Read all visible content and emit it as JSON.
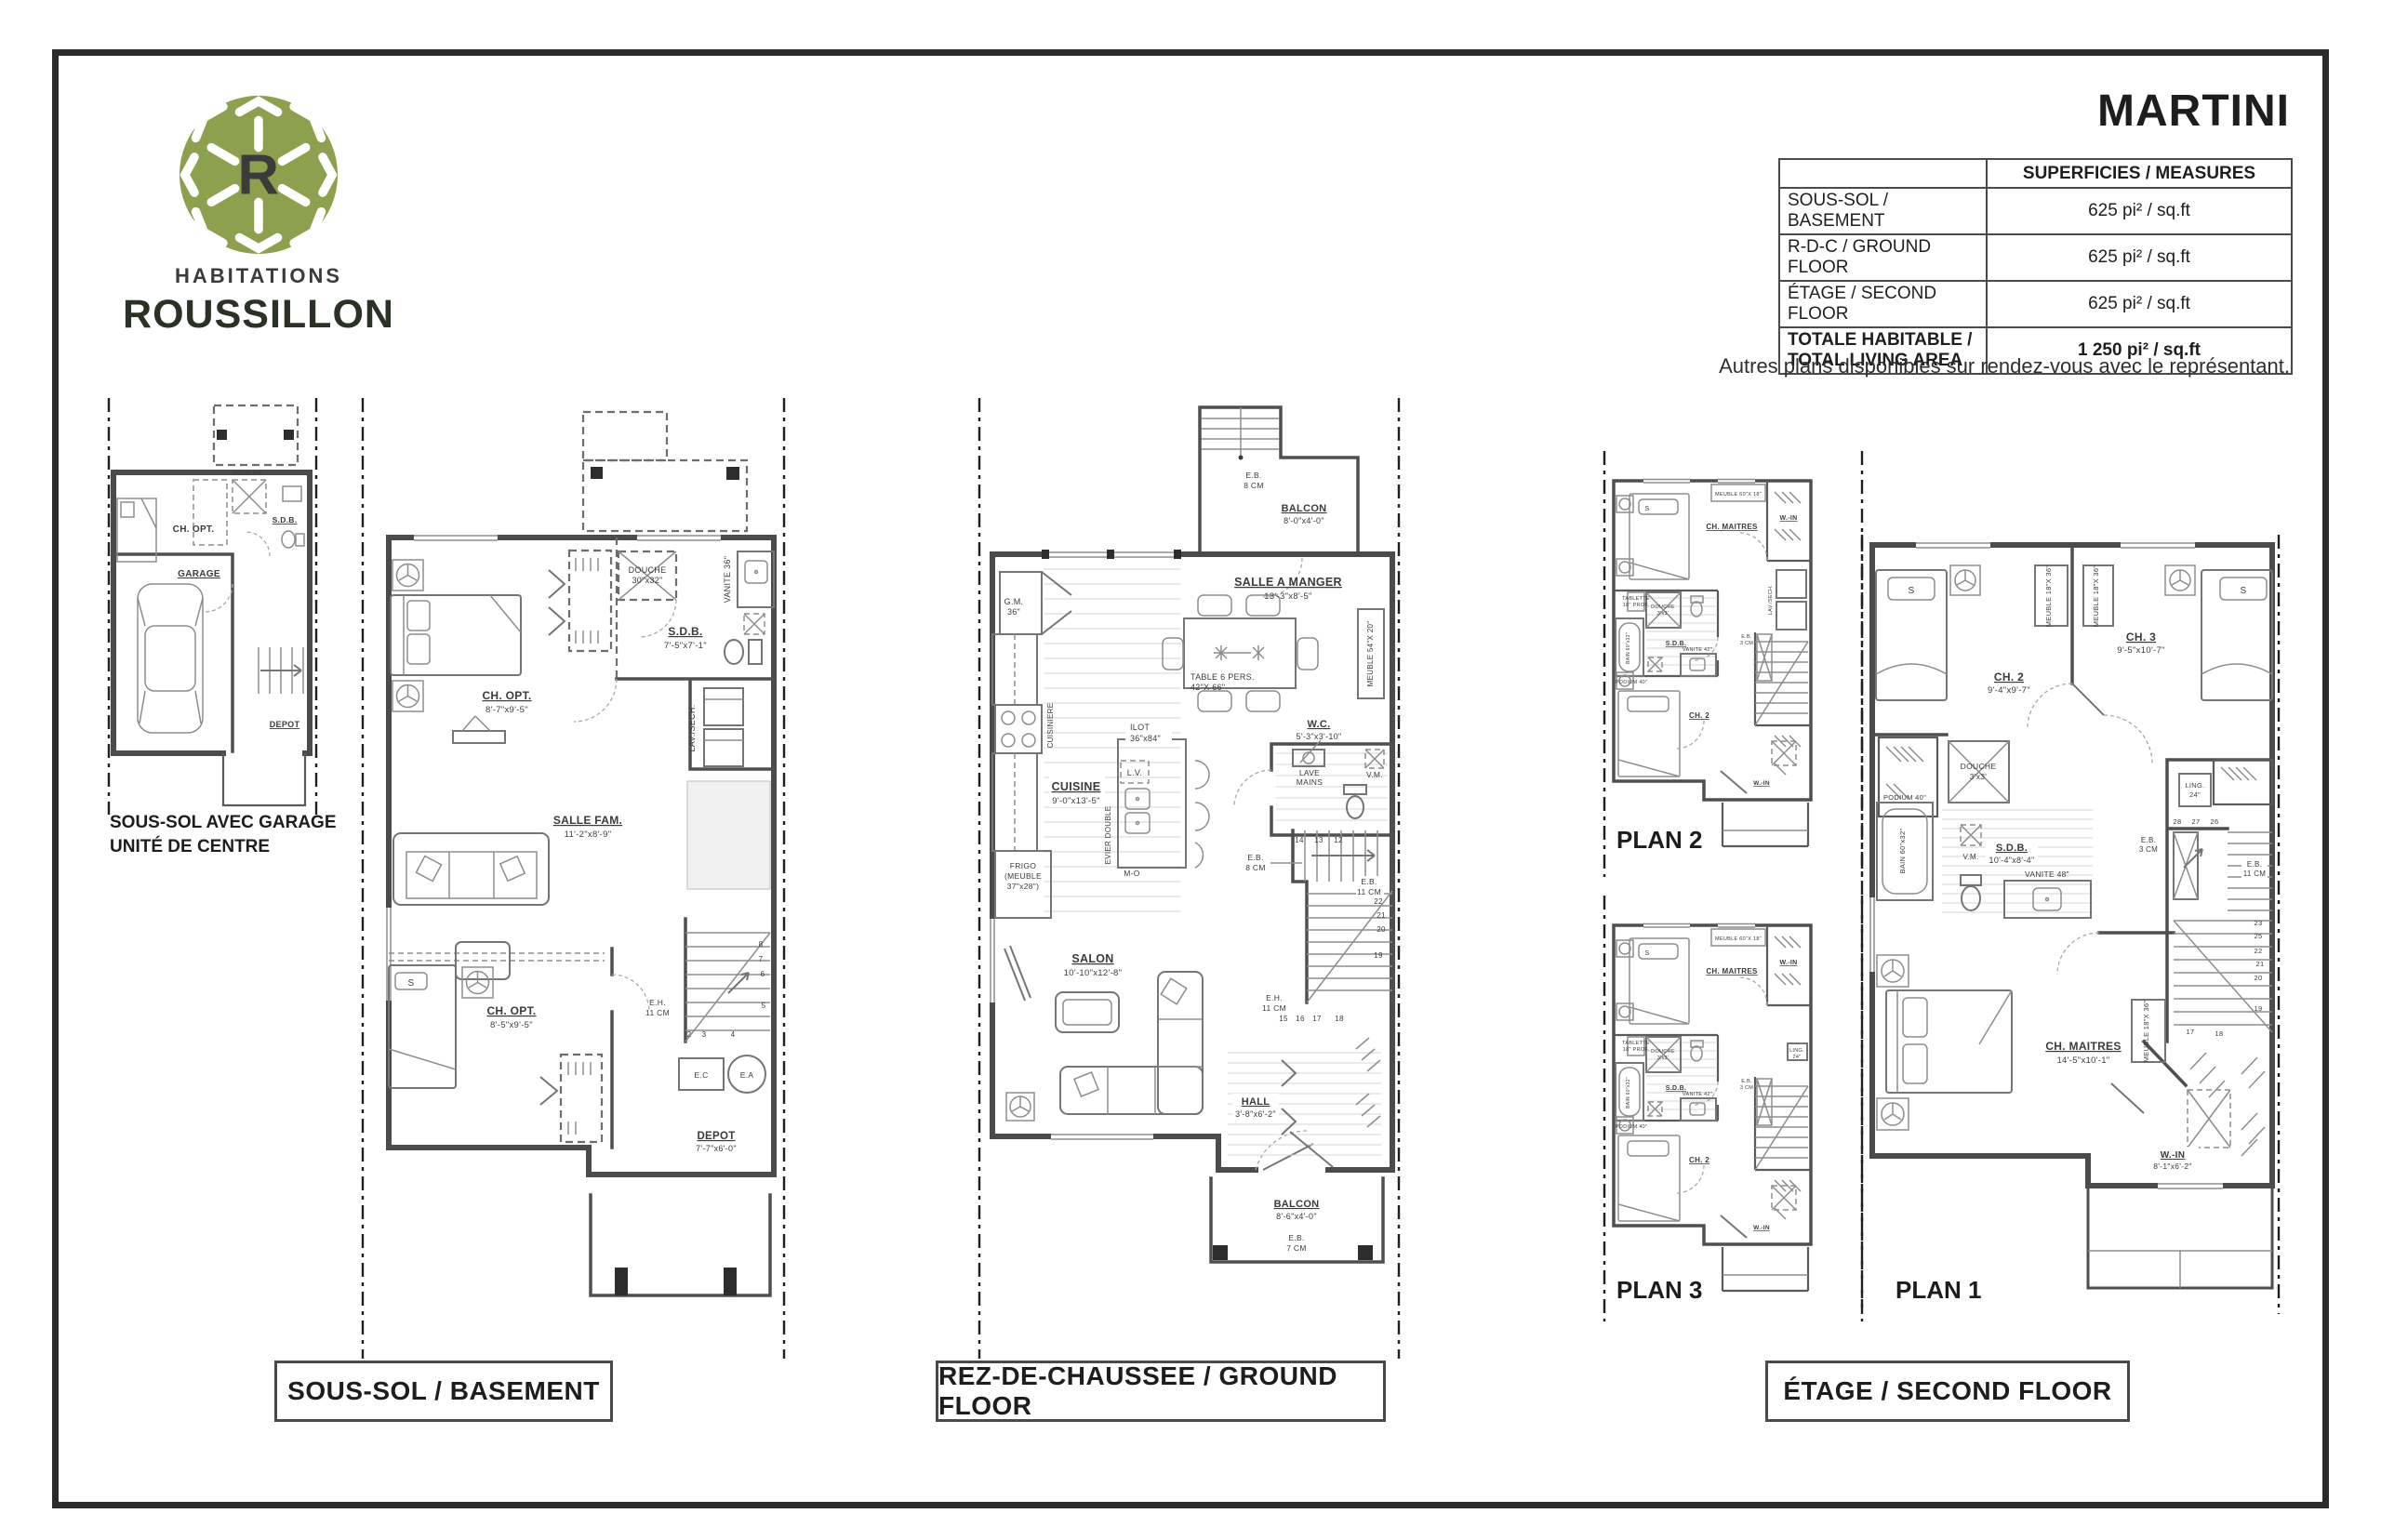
{
  "theme": {
    "ink": "#2b2b2b",
    "brand-green": "#8ca04e",
    "brand-dark": "#2a3226",
    "line-gray": "#4b4b4b"
  },
  "brand": {
    "monogram": "R",
    "line1": "HABITATIONS",
    "line2": "ROUSSILLON"
  },
  "header": {
    "title": "MARTINI",
    "note": "Autres plans disponibles sur rendez-vous avec le représentant."
  },
  "table": {
    "header": "SUPERFICIES / MEASURES",
    "rows": [
      {
        "label": "SOUS-SOL / BASEMENT",
        "value": "625 pi² / sq.ft"
      },
      {
        "label": "R-D-C / GROUND FLOOR",
        "value": "625 pi² / sq.ft"
      },
      {
        "label": "ÉTAGE / SECOND FLOOR",
        "value": "625 pi² / sq.ft"
      }
    ],
    "total": {
      "label1": "TOTALE HABITABLE /",
      "label2": "TOTAL LIVING AREA",
      "value": "1 250 pi² / sq.ft"
    }
  },
  "captions": {
    "basement": "SOUS-SOL / BASEMENT",
    "ground": "REZ-DE-CHAUSSEE / GROUND FLOOR",
    "etage": "ÉTAGE / SECOND FLOOR"
  },
  "plan_tags": {
    "plan1": "PLAN 1",
    "plan2": "PLAN 2",
    "plan3": "PLAN 3"
  },
  "garage_plan": {
    "caption1": "SOUS-SOL AVEC GARAGE",
    "caption2": "UNITÉ DE CENTRE",
    "ch_opt": "CH. OPT.",
    "garage": "GARAGE",
    "sdb": "S.D.B.",
    "douche": "DOUCHE",
    "depot": "DEPOT"
  },
  "basement": {
    "ch_opt_top": "CH. OPT.",
    "ch_opt_top_dim": "8'-7\"x9'-5\"",
    "douche": "DOUCHE",
    "douche_dim": "30\"x32\"",
    "vanite": "VANITE 36\"",
    "sdb": "S.D.B.",
    "sdb_dim": "7'-5\"x7'-1\"",
    "lav": "LAV./SECH.",
    "salle_fam": "SALLE FAM.",
    "salle_fam_dim": "11'-2\"x8'-9\"",
    "ch_opt_bot": "CH. OPT.",
    "ch_opt_bot_dim": "8'-5\"x9'-5\"",
    "eh1": "E.H.",
    "eh2": "11 CM",
    "ec": "E.C",
    "ea": "E.A",
    "depot": "DEPOT",
    "depot_dim": "7'-7\"x6'-0\"",
    "s": "S",
    "n2": "2",
    "n3": "3",
    "n4": "4",
    "n5": "5",
    "n6": "6",
    "n7": "7",
    "n8": "8"
  },
  "ground": {
    "eb_top1": "E.B.",
    "eb_top2": "8 CM",
    "balcon_top": "BALCON",
    "balcon_top_dim": "8'-0\"x4'-0\"",
    "salle": "SALLE A MANGER",
    "salle_dim": "13'-3\"x8'-5\"",
    "table1": "TABLE 6 PERS.",
    "table2": "42\"X 66\"",
    "meuble": "MEUBLE 54\"X 20\"",
    "gm1": "G.M.",
    "gm2": "36\"",
    "cuisiniere": "CUISINIERE",
    "cuisine": "CUISINE",
    "cuisine_dim": "9'-0\"x13'-5\"",
    "ilot1": "ILOT",
    "ilot2": "36\"x84\"",
    "lv": "L.V.",
    "evier": "EVIER DOUBLE",
    "frigo1": "FRIGO",
    "frigo2": "(MEUBLE",
    "frigo3": "37\"x28\")",
    "mo": "M-O",
    "wc": "W.C.",
    "wc_dim": "5'-3\"x3'-10\"",
    "lave1": "LAVE",
    "lave2": "MAINS",
    "vm": "V.M.",
    "ebA1": "E.B.",
    "ebA2": "8 CM",
    "ebB1": "E.B.",
    "ebB2": "11 CM",
    "eh1": "E.H.",
    "eh2": "11 CM",
    "salon": "SALON",
    "salon_dim": "10'-10\"x12'-8\"",
    "hall": "HALL",
    "hall_dim": "3'-8\"x6'-2\"",
    "balcon_bot": "BALCON",
    "balcon_bot_dim": "8'-6\"x4'-0\"",
    "eb_bot1": "E.B.",
    "eb_bot2": "7 CM",
    "n12": "12",
    "n13": "13",
    "n14": "14",
    "n15": "15",
    "n16": "16",
    "n17": "17",
    "n18": "18",
    "n19": "19",
    "n20": "20",
    "n21": "21",
    "n22": "22"
  },
  "etage": {
    "ch2": "CH. 2",
    "ch2_dim": "9'-4\"x9'-7\"",
    "ch3": "CH. 3",
    "ch3_dim": "9'-5\"x10'-7\"",
    "meuble": "MEUBLE 18\"X 36\"",
    "s": "S",
    "douche1": "DOUCHE",
    "douche2": "3'x3'",
    "podium": "PODIUM 40\"",
    "bain": "BAIN 60\"x32\"",
    "sdb": "S.D.B.",
    "sdb_dim": "10'-4\"x8'-4\"",
    "vm": "V.M.",
    "vanite": "VANITE 48\"",
    "ling1": "LING.",
    "ling2": "24\"",
    "eb31": "E.B.",
    "eb32": "3 CM",
    "eb111": "E.B.",
    "eb112": "11 CM",
    "chm": "CH. MAITRES",
    "chm_dim": "14'-5\"x10'-1\"",
    "win": "W.-IN",
    "win_dim": "8'-1\"x6'-2\"",
    "n17": "17",
    "n18": "18",
    "n19": "19",
    "n20": "20",
    "n21": "21",
    "n22": "22",
    "n23": "23",
    "n25": "25",
    "n26": "26",
    "n27": "27",
    "n28": "28"
  },
  "unit_plan": {
    "ch_maitres": "CH. MAITRES",
    "meuble": "MEUBLE 60\"X 18\"",
    "win": "W.-IN",
    "tablette1": "TABLETTE",
    "tablette2": "18\" PROF.",
    "douche1": "DOUCHE",
    "douche2": "3'x3'",
    "sdb": "S.D.B.",
    "vanite": "VANITE 42\"",
    "bain": "BAIN 60\"x32\"",
    "podium": "PODIUM 40\"",
    "lav": "LAV./SECH.",
    "eb1": "E.B.",
    "eb2": "3 CM",
    "ch2": "CH. 2",
    "win2": "W.-IN",
    "ling1": "LING.",
    "ling2": "24\"",
    "s": "S"
  }
}
